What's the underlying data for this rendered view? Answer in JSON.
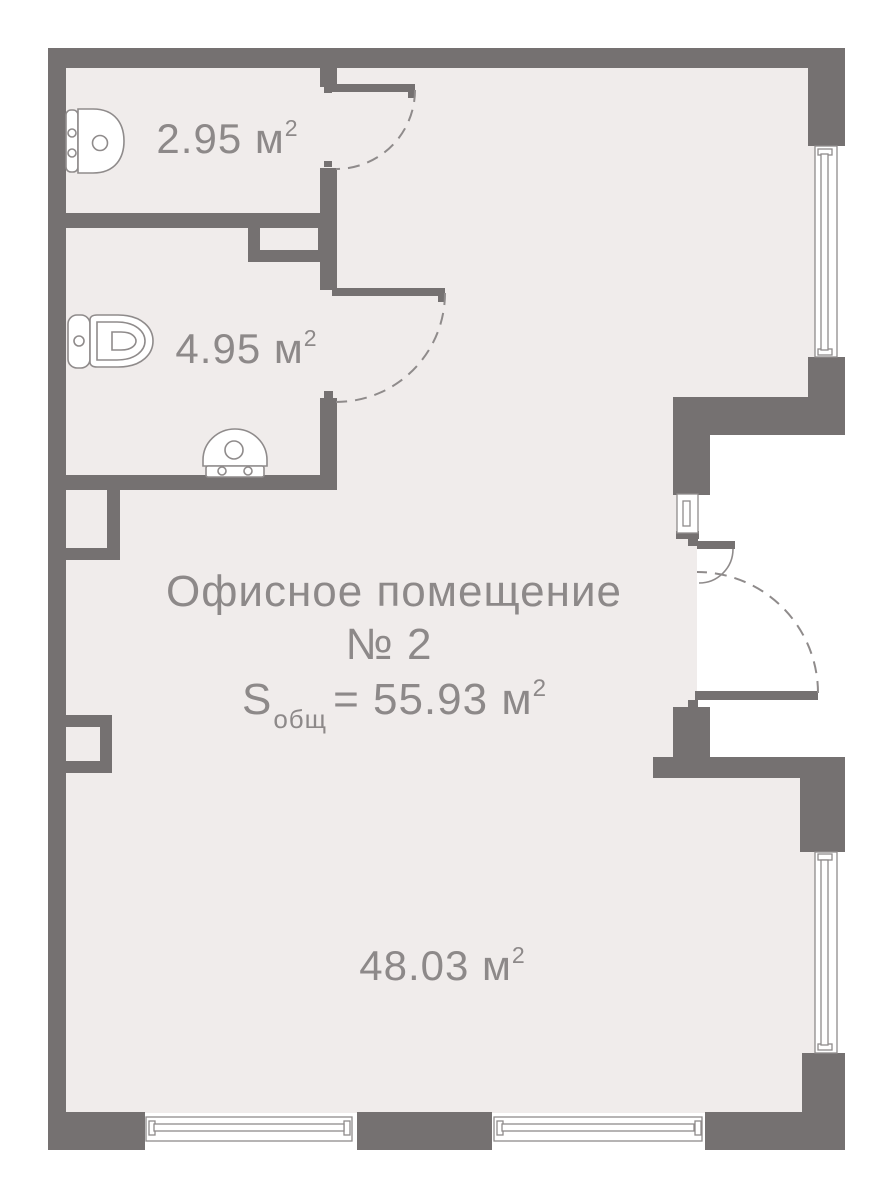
{
  "plan": {
    "title_line1": "Офисное помещение",
    "title_line2": "№ 2",
    "total_area": {
      "s": "S",
      "sub": "общ",
      "eq": "= 55.93 м",
      "sup": "2"
    },
    "rooms": [
      {
        "name": "bathroom-small",
        "area": "2.95 м",
        "sup": "2"
      },
      {
        "name": "bathroom-large",
        "area": "4.95 м",
        "sup": "2"
      },
      {
        "name": "office-main",
        "area": "48.03 м",
        "sup": "2"
      }
    ],
    "fixtures": [
      {
        "icon": "washbasin-icon",
        "room": "bathroom-small"
      },
      {
        "icon": "toilet-icon",
        "room": "bathroom-large"
      },
      {
        "icon": "sink-icon",
        "room": "bathroom-large"
      }
    ]
  },
  "colors": {
    "wall": "#757171",
    "floor": "#f0eceb",
    "outline": "#8f8b8b",
    "text": "#8d8989",
    "bg": "#ffffff"
  }
}
